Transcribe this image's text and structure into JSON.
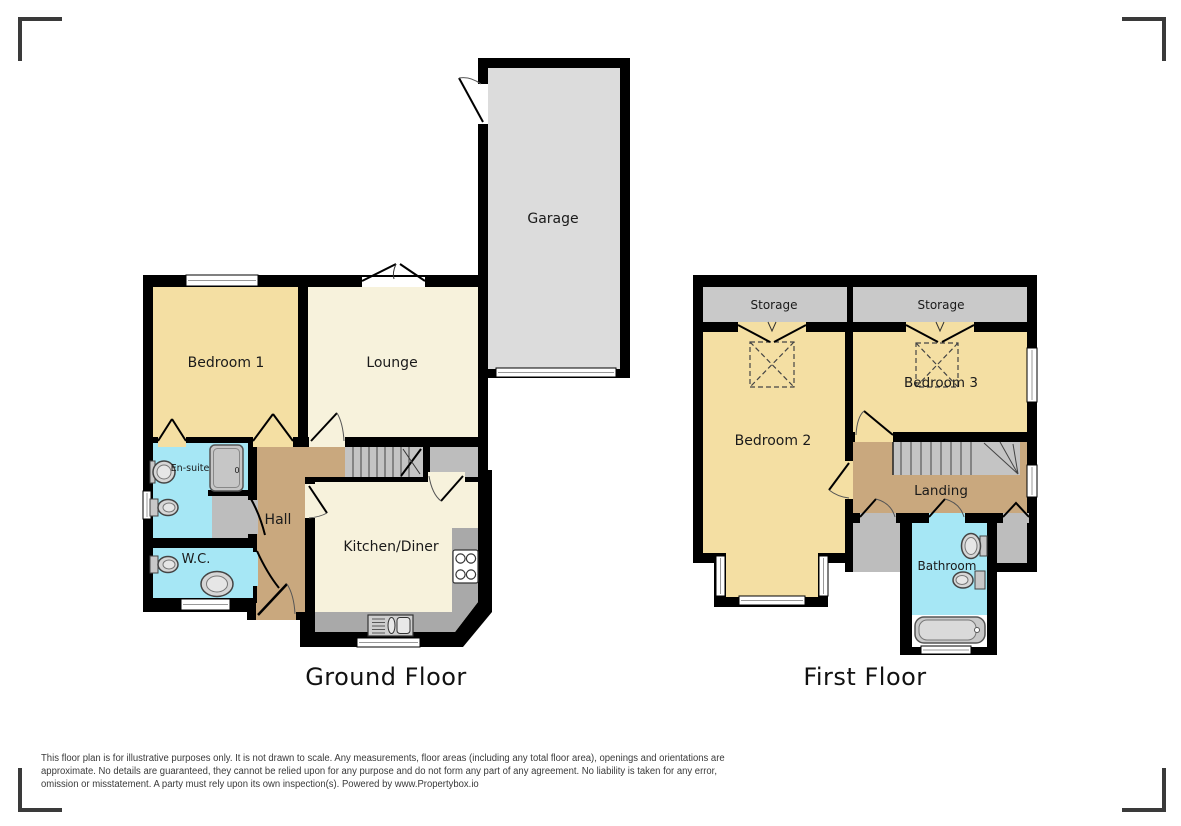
{
  "floors": {
    "ground": {
      "title": "Ground Floor",
      "rooms": {
        "garage": "Garage",
        "bedroom1": "Bedroom 1",
        "lounge": "Lounge",
        "ensuite": "En-suite",
        "wc": "W.C.",
        "hall": "Hall",
        "kitchen_diner": "Kitchen/Diner"
      },
      "fixtures": {
        "shower_drain": "0"
      }
    },
    "first": {
      "title": "First Floor",
      "rooms": {
        "storage_left": "Storage",
        "storage_right": "Storage",
        "bedroom2": "Bedroom 2",
        "bedroom3": "Bedroom 3",
        "landing": "Landing",
        "bathroom": "Bathroom"
      }
    }
  },
  "disclaimer": {
    "line1": "This floor plan is for illustrative purposes only. It is not drawn to scale. Any measurements, floor areas (including any total floor area), openings and orientations are",
    "line2": "approximate. No details are guaranteed, they cannot be relied upon for any purpose and do not form any part of any agreement. No liability is taken for any error,",
    "line3": "omission or misstatement. A party must rely upon its own inspection(s). Powered by www.Propertybox.io"
  },
  "colors": {
    "wall": "#000000",
    "bedroom": "#F4DFA3",
    "living": "#F7F2DC",
    "wet_room": "#A6E7F5",
    "hall": "#C9A87E",
    "garage": "#DCDCDC",
    "storage": "#C9C9C9",
    "stairs": "#C4C4C4",
    "cupboard": "#BDBDBD",
    "counter": "#A9A9A9",
    "corner_mark": "#3A3A3A"
  }
}
